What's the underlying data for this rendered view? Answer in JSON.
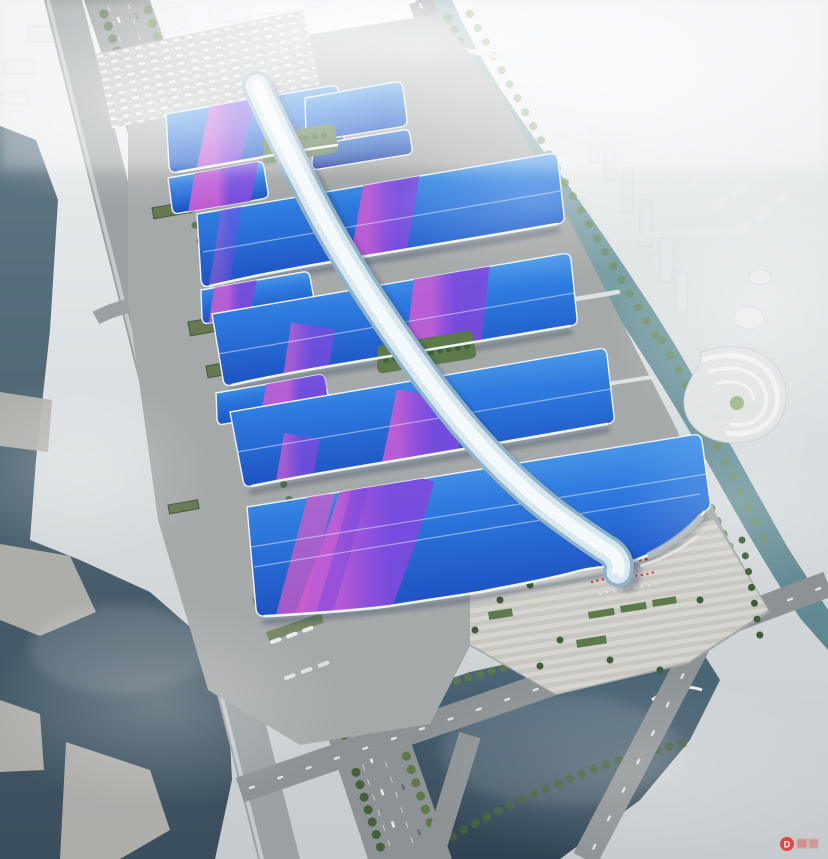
{
  "meta": {
    "title": "Aerial rendering of a riverside exhibition and convention center with blue-and-purple ribbon roofs and a white central canopy spine",
    "style": "hazy daylight architectural visualization"
  },
  "watermark": {
    "letter": "D"
  },
  "palette": {
    "sky_top": "#eef1f2",
    "sky_bottom": "#c5cbce",
    "city_white": "#e9edef",
    "roof_light": "#66b6f0",
    "roof_mid": "#2f7ce0",
    "roof_deep": "#1c4fc0",
    "roof_navy": "#16349c",
    "ribbon_magenta": "#c55cd4",
    "ribbon_violet": "#7b4ade",
    "ribbon_pink": "#d05cc8",
    "spine_white": "#f3f9fc",
    "spine_mid": "#d6e6ef",
    "spine_edge": "#8fb2c8",
    "ground": "#a6a9a9",
    "road": "#8d9294",
    "plaza_light": "#d6d4cf",
    "plaza_dark": "#c8c6c1",
    "green_dark": "#44603c",
    "green_mid": "#5d7a4a",
    "green_light": "#72925a",
    "water_river_top": "#5e7683",
    "water_river_deep": "#3a4e5d",
    "water_pond_top": "#4f6b7c",
    "water_pond_deep": "#2f4253",
    "water_canal_top": "#8fb0b4",
    "water_canal_deep": "#5f8791",
    "red_accent": "#cf2f28",
    "watermark_red": "#e03028"
  },
  "scene": {
    "regions": [
      "background-city",
      "east-canal",
      "west-river",
      "south-pond",
      "west-avenue",
      "elevated-expressway",
      "north-parking-lot",
      "exhibition-hall-bands",
      "central-canopy-spine",
      "south-grand-hall",
      "south-entrance-plaza",
      "spiral-pavilion",
      "palm-promenade",
      "red-crowd-accents",
      "canal-bridges"
    ]
  }
}
